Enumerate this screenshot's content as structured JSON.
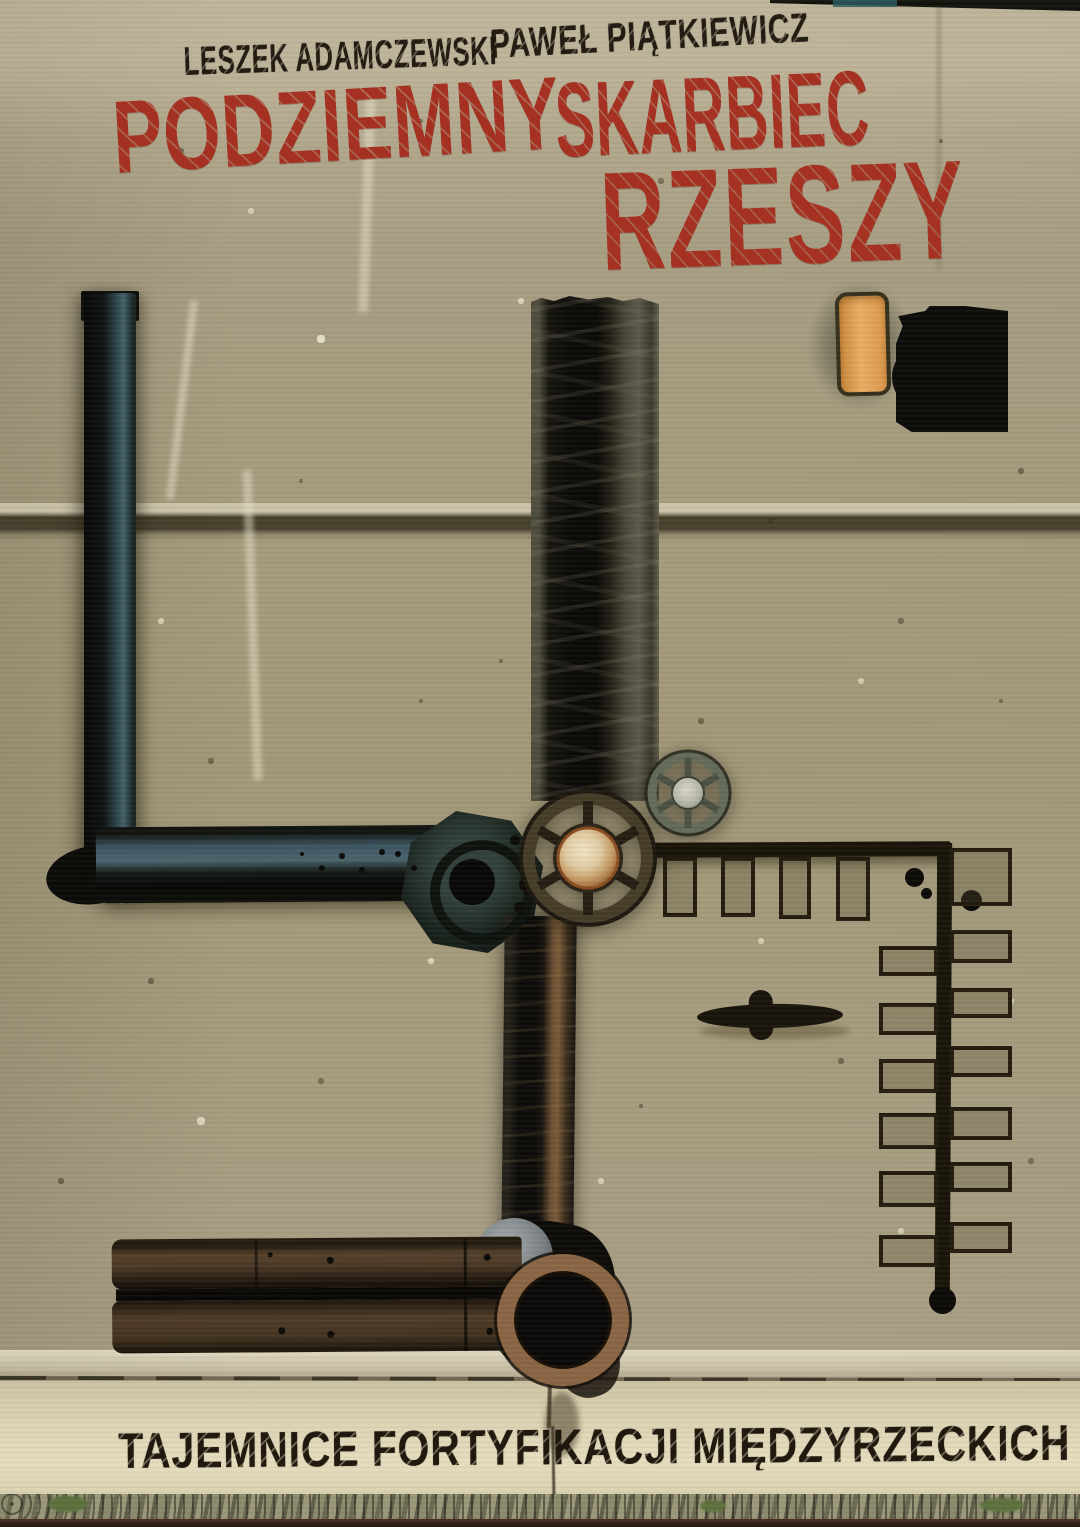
{
  "cover": {
    "authors": {
      "left": "LESZEK ADAMCZEWSKI",
      "right": "PAWEŁ PIĄTKIEWICZ"
    },
    "title": {
      "top_left": "PODZIEMNY",
      "top_right": "SKARBIEC",
      "bottom": "RZESZY"
    },
    "subtitle": "TAJEMNICE FORTYFIKACJI MIĘDZYRZECKICH",
    "colors": {
      "title_red": "#a53122",
      "author_ink": "#26221a",
      "subtitle_ink": "#221a10",
      "concrete_base": "#a49a7f",
      "bottom_band": "#e0d7b9",
      "steel_highlight": "#44616b",
      "rust": "#8a6544",
      "signal_orange": "#e2a050",
      "metal_black": "#0b0b09"
    }
  }
}
